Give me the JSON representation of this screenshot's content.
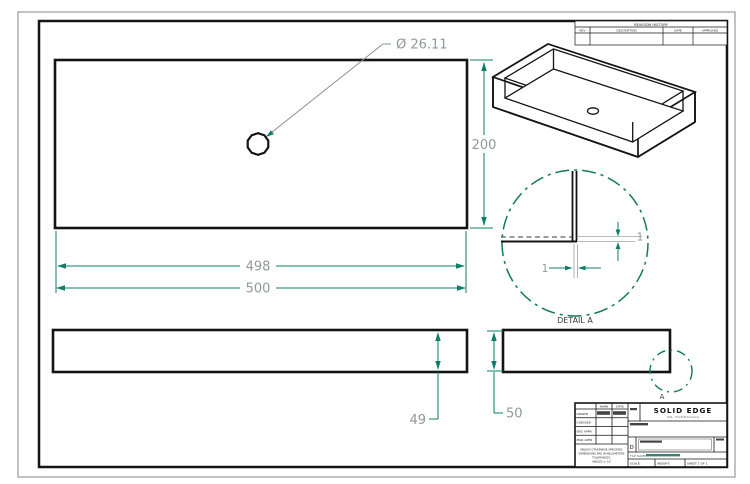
{
  "colors": {
    "background": "#ffffff",
    "geometry": "#141414",
    "dimension_line": "#0e7e6a",
    "dimension_text": "#8f9a94",
    "detail_boundary": "#117a5e"
  },
  "revision_table": {
    "title": "REVISION HISTORY",
    "col_rev": "REV",
    "col_description": "DESCRIPTION",
    "col_date": "DATE",
    "col_approved": "APPROVED"
  },
  "front_view": {
    "hole_callout": "Ø 26.11",
    "dim_height": "200",
    "dim_width_inner": "498",
    "dim_width_outer": "500"
  },
  "bottom_views": {
    "dim_depth_inner": "49",
    "dim_depth_outer": "50",
    "detail_marker": "A"
  },
  "detail_view": {
    "label": "DETAIL A",
    "dim_wall_right": "1",
    "dim_wall_bottom": "1"
  },
  "title_block": {
    "logo": "SOLID EDGE",
    "logo_subtitle": "UGS - The PLM Company",
    "col_name": "NAME",
    "col_date": "DATE",
    "row_drawn": "DRAWN",
    "row_checked": "CHECKED",
    "row_eng_appr": "ENG APPR",
    "row_mgr_appr": "MGR APPR",
    "note_line1": "UNLESS OTHERWISE SPECIFIED:",
    "note_line2": "DIMENSIONS ARE IN MILLIMETERS",
    "note_line3": "TOLERANCES:",
    "note_line4": "ANGLES ± 0.5",
    "size_value": "D",
    "file_label": "FILE NAME:",
    "scale_label": "SCALE:",
    "weight_label": "WEIGHT:",
    "sheet_label": "SHEET 1 OF 1"
  }
}
